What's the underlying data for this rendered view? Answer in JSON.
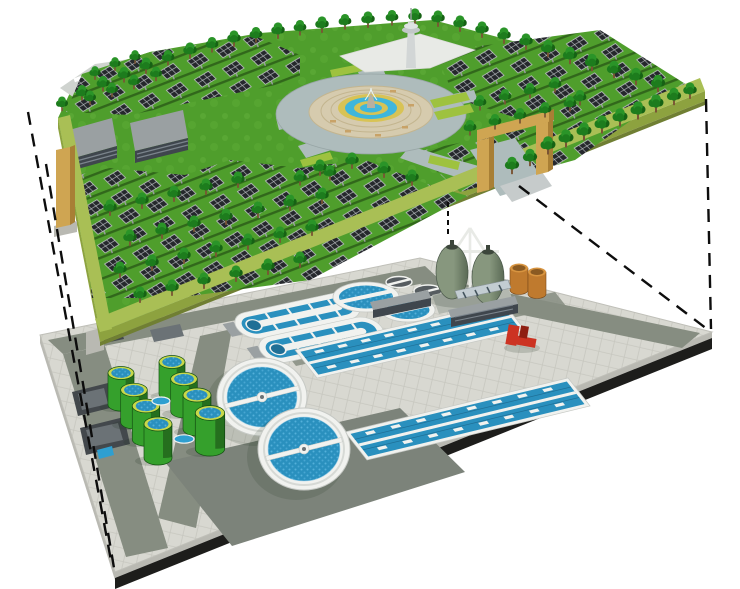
{
  "palette": {
    "grass": "#4f9e2c",
    "grassLight": "#5fae38",
    "band": "#a9bf55",
    "bandSide": "#8da23f",
    "bandDark": "#707f33",
    "panel": "#25282c",
    "panelGrid": "#c8ccd0",
    "rowShadow": "#214a12",
    "tree": "#1d7c1d",
    "treeLight": "#2a9428",
    "treeDark": "#166214",
    "trunk": "#7a5434",
    "roof": "#9aa0a2",
    "bldgFront": "#3f464d",
    "stripe": "#7b848c",
    "plazaRoad": "#aebcbc",
    "paver": "#d6cbae",
    "paverLine": "#c3b58f",
    "fYellow": "#d8c355",
    "fBlue": "#3fb6dc",
    "rock": "#b8b0a0",
    "tower": "#d2d6d6",
    "ghost": "#e8eae6",
    "tan": "#cfa552",
    "tanDark": "#a87f35",
    "hedge": "#9ec23f",
    "pav": "#d8d8d1",
    "pavLine": "#c7c7bf",
    "road": "#868d81",
    "patch": "#7c837a",
    "edgeLight": "#b9b9b2",
    "edgeDark": "#1d1d1b",
    "white": "#f1f2ef",
    "wall": "#c6c9c5",
    "water": "#2a90be",
    "waterLight": "#54b0da",
    "tankGreen": "#35a02c",
    "tankGreenDark": "#1f6e1c",
    "tankRim": "#c8d84a",
    "olive": "#87977e",
    "oliveDark": "#5a6a55",
    "cap": "#3c463b",
    "orange": "#bf7a2e",
    "orangeDark": "#8a5a22",
    "orangeLight": "#d79440",
    "red": "#cc3322",
    "redDark": "#8f1f12",
    "screen": "#43484c",
    "screenGrid": "#6b7276",
    "blueSmall": "#2f9fd0",
    "dash": "#0d0d0d"
  },
  "scene": {
    "upper_level": {
      "name": "solar-park-surface",
      "components": [
        "solar-panel-arrays",
        "trees",
        "central-fountain-plaza",
        "ring-road",
        "service-buildings",
        "observation-tower",
        "entrance-gate",
        "perimeter-planter-band"
      ],
      "building_count": 2,
      "trees": [
        [
          62,
          106,
          0.8
        ],
        [
          82,
          95,
          0.85
        ],
        [
          103,
          86,
          0.85
        ],
        [
          124,
          77,
          0.85
        ],
        [
          146,
          68,
          0.9
        ],
        [
          168,
          60,
          0.85
        ],
        [
          190,
          53,
          0.9
        ],
        [
          212,
          47,
          0.85
        ],
        [
          234,
          41,
          0.9
        ],
        [
          256,
          37,
          0.85
        ],
        [
          278,
          33,
          0.9
        ],
        [
          300,
          30,
          0.85
        ],
        [
          322,
          27,
          0.9
        ],
        [
          345,
          24,
          0.85
        ],
        [
          368,
          22,
          0.9
        ],
        [
          392,
          20,
          0.85
        ],
        [
          415,
          19,
          0.9
        ],
        [
          438,
          21,
          0.9
        ],
        [
          460,
          26,
          0.9
        ],
        [
          482,
          32,
          0.9
        ],
        [
          504,
          38,
          0.9
        ],
        [
          526,
          44,
          0.9
        ],
        [
          548,
          51,
          0.95
        ],
        [
          570,
          58,
          0.95
        ],
        [
          592,
          65,
          0.95
        ],
        [
          614,
          72,
          0.95
        ],
        [
          636,
          79,
          0.95
        ],
        [
          658,
          86,
          0.95
        ],
        [
          548,
          148,
          1
        ],
        [
          566,
          141,
          1
        ],
        [
          584,
          134,
          1
        ],
        [
          602,
          127,
          1
        ],
        [
          620,
          120,
          1
        ],
        [
          638,
          113,
          1
        ],
        [
          656,
          106,
          1
        ],
        [
          674,
          99,
          0.95
        ],
        [
          690,
          93,
          0.9
        ],
        [
          530,
          160,
          0.95
        ],
        [
          512,
          168,
          0.95
        ],
        [
          140,
          297,
          0.9
        ],
        [
          172,
          290,
          0.9
        ],
        [
          204,
          283,
          0.9
        ],
        [
          236,
          276,
          0.9
        ],
        [
          268,
          269,
          0.9
        ],
        [
          300,
          262,
          0.9
        ],
        [
          120,
          272,
          0.9
        ],
        [
          152,
          265,
          0.9
        ],
        [
          184,
          258,
          0.9
        ],
        [
          216,
          251,
          0.9
        ],
        [
          248,
          244,
          0.9
        ],
        [
          280,
          237,
          0.9
        ],
        [
          312,
          230,
          0.9
        ],
        [
          130,
          240,
          0.9
        ],
        [
          162,
          233,
          0.9
        ],
        [
          194,
          226,
          0.9
        ],
        [
          226,
          219,
          0.9
        ],
        [
          258,
          212,
          0.9
        ],
        [
          290,
          205,
          0.9
        ],
        [
          322,
          198,
          0.9
        ],
        [
          110,
          210,
          0.9
        ],
        [
          142,
          203,
          0.9
        ],
        [
          174,
          196,
          0.9
        ],
        [
          206,
          189,
          0.9
        ],
        [
          238,
          182,
          0.9
        ],
        [
          320,
          170,
          0.9
        ],
        [
          352,
          163,
          0.9
        ],
        [
          384,
          172,
          0.9
        ],
        [
          412,
          180,
          0.9
        ],
        [
          330,
          175,
          0.85
        ],
        [
          300,
          180,
          0.85
        ],
        [
          470,
          130,
          0.85
        ],
        [
          495,
          124,
          0.85
        ],
        [
          520,
          118,
          0.85
        ],
        [
          545,
          112,
          0.85
        ],
        [
          570,
          106,
          0.85
        ],
        [
          480,
          105,
          0.85
        ],
        [
          505,
          99,
          0.85
        ],
        [
          530,
          93,
          0.85
        ],
        [
          555,
          87,
          0.85
        ],
        [
          580,
          100,
          0.85
        ],
        [
          90,
          100,
          0.8
        ],
        [
          112,
          92,
          0.8
        ],
        [
          134,
          84,
          0.8
        ],
        [
          156,
          76,
          0.8
        ],
        [
          95,
          75,
          0.75
        ],
        [
          115,
          66,
          0.75
        ],
        [
          135,
          59,
          0.75
        ]
      ]
    },
    "lower_level": {
      "name": "underground-wastewater-treatment-plant",
      "components": [
        "circular-clarifiers",
        "oxidation-ditches",
        "aeration-basins",
        "sludge-holding-tanks",
        "egg-shaped-digesters",
        "storage-tanks",
        "pump-equipment",
        "inlet-screens"
      ],
      "green_tanks": [
        [
          121,
          373,
          0.93
        ],
        [
          134,
          390,
          0.95
        ],
        [
          146,
          406,
          0.98
        ],
        [
          158,
          424,
          1.0
        ],
        [
          172,
          362,
          0.93
        ],
        [
          184,
          379,
          0.95
        ],
        [
          197,
          395,
          1.0
        ],
        [
          210,
          413,
          1.05
        ]
      ],
      "clarifiers": [
        {
          "cx": 262,
          "cy": 397,
          "rx": 45,
          "ry": 39
        },
        {
          "cx": 304,
          "cy": 449,
          "rx": 46,
          "ry": 41
        }
      ],
      "egg_digesters": 2,
      "oxidation_ditches": 2,
      "aeration_basins": 2,
      "storage_tanks_orange": 2
    },
    "connector_lines": [
      {
        "x1": 28,
        "y1": 112,
        "x2": 112,
        "y2": 566,
        "dash": "13 9",
        "w": 2.4
      },
      {
        "x1": 46,
        "y1": 164,
        "x2": 114,
        "y2": 568,
        "dash": "13 9",
        "w": 2.4
      },
      {
        "x1": 448,
        "y1": 202,
        "x2": 448,
        "y2": 237,
        "dash": "5 4",
        "w": 2
      },
      {
        "x1": 519,
        "y1": 186,
        "x2": 707,
        "y2": 329,
        "dash": "13 9",
        "w": 2.4
      },
      {
        "x1": 706,
        "y1": 99,
        "x2": 711,
        "y2": 329,
        "dash": "13 9",
        "w": 2.4
      }
    ]
  }
}
